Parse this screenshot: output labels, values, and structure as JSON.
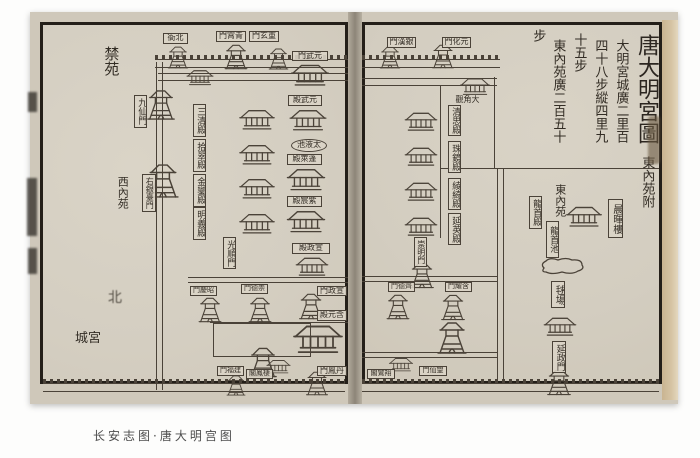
{
  "caption": "长安志图·唐大明宫图",
  "title": {
    "main": "唐大明宮圖",
    "sub": "東內苑附"
  },
  "measure_columns": [
    {
      "name": "measure-col-1",
      "text": "大明宮城廣二里百",
      "x": 612,
      "y": 26,
      "h": 130
    },
    {
      "name": "measure-col-2",
      "text": "四十八步縱四里九",
      "x": 591,
      "y": 26,
      "h": 130
    },
    {
      "name": "measure-col-3",
      "text": "十五步",
      "x": 570,
      "y": 26,
      "h": 52
    },
    {
      "name": "measure-col-4",
      "text": "東內苑廣二百五十",
      "x": 549,
      "y": 26,
      "h": 130
    },
    {
      "name": "measure-col-5",
      "text": "步",
      "x": 529,
      "y": 26,
      "h": 18
    }
  ],
  "north_mark": "北",
  "labels": [
    {
      "name": "label-beiya",
      "text": "衙北",
      "type": "box-h",
      "x": 163,
      "y": 33,
      "w": 25,
      "h": 11,
      "fs": 8
    },
    {
      "name": "label-qingxiao-gate",
      "text": "門霄青",
      "type": "box-h",
      "x": 216,
      "y": 31,
      "w": 30,
      "h": 11,
      "fs": 8
    },
    {
      "name": "label-chongxuan-gate",
      "text": "門玄重",
      "type": "box-h",
      "x": 249,
      "y": 31,
      "w": 30,
      "h": 11,
      "fs": 8
    },
    {
      "name": "label-yuanwu-gate",
      "text": "門武元",
      "type": "box-h",
      "x": 292,
      "y": 51,
      "w": 36,
      "h": 10,
      "fs": 8
    },
    {
      "name": "label-yuanwu-hall",
      "text": "殿武元",
      "type": "box-h",
      "x": 288,
      "y": 95,
      "w": 34,
      "h": 11,
      "fs": 8
    },
    {
      "name": "label-taiye-pool",
      "text": "池液太",
      "type": "oval",
      "x": 291,
      "y": 139,
      "w": 36,
      "h": 13,
      "fs": 8
    },
    {
      "name": "label-penglai-hall",
      "text": "殿萊蓬",
      "type": "box-h",
      "x": 287,
      "y": 154,
      "w": 35,
      "h": 11,
      "fs": 8
    },
    {
      "name": "label-zichen-hall",
      "text": "殿宸紫",
      "type": "box-h",
      "x": 287,
      "y": 196,
      "w": 35,
      "h": 11,
      "fs": 8
    },
    {
      "name": "label-xuanzheng-hall",
      "text": "殿政宣",
      "type": "box-h",
      "x": 292,
      "y": 243,
      "w": 38,
      "h": 11,
      "fs": 8
    },
    {
      "name": "label-xuanzheng-gate",
      "text": "門政宣",
      "type": "box-h",
      "x": 317,
      "y": 286,
      "w": 30,
      "h": 10,
      "fs": 8
    },
    {
      "name": "label-hanyuan-hall",
      "text": "殿元含",
      "type": "box-h",
      "x": 317,
      "y": 310,
      "w": 30,
      "h": 11,
      "fs": 8
    },
    {
      "name": "label-danfeng-gate",
      "text": "門鳳丹",
      "type": "box-h",
      "x": 317,
      "y": 366,
      "w": 30,
      "h": 10,
      "fs": 8
    },
    {
      "name": "label-jianfu-gate",
      "text": "門福建",
      "type": "box-h",
      "x": 217,
      "y": 366,
      "w": 27,
      "h": 10,
      "fs": 7
    },
    {
      "name": "label-qifeng-pavilion",
      "text": "閣鳳棲",
      "type": "box-h",
      "x": 246,
      "y": 369,
      "w": 27,
      "h": 10,
      "fs": 7
    },
    {
      "name": "label-zhaoqing-gate",
      "text": "門慶昭",
      "type": "box-h",
      "x": 190,
      "y": 286,
      "w": 27,
      "h": 10,
      "fs": 7
    },
    {
      "name": "label-chongde-gate",
      "text": "門德崇",
      "type": "box-h",
      "x": 241,
      "y": 284,
      "w": 27,
      "h": 10,
      "fs": 7
    },
    {
      "name": "label-guangshun-gate",
      "text": "光順門",
      "type": "box-v",
      "x": 223,
      "y": 237,
      "w": 13,
      "h": 32,
      "fs": 9
    },
    {
      "name": "label-jiuxian-gate",
      "text": "九仙門",
      "type": "box-v",
      "x": 134,
      "y": 95,
      "w": 13,
      "h": 33,
      "fs": 9
    },
    {
      "name": "label-youyintai-gate",
      "text": "右銀臺門",
      "type": "box-v",
      "x": 142,
      "y": 174,
      "w": 14,
      "h": 38,
      "fs": 8
    },
    {
      "name": "label-sanqing-hall",
      "text": "三清殿",
      "type": "box-v",
      "x": 193,
      "y": 104,
      "w": 13,
      "h": 33,
      "fs": 9
    },
    {
      "name": "label-shicui-hall",
      "text": "拾翠殿",
      "type": "box-v",
      "x": 193,
      "y": 139,
      "w": 13,
      "h": 33,
      "fs": 9
    },
    {
      "name": "label-jinluan-hall",
      "text": "金鑾殿",
      "type": "box-v",
      "x": 193,
      "y": 174,
      "w": 13,
      "h": 33,
      "fs": 9
    },
    {
      "name": "label-mingyi-hall",
      "text": "明義殿",
      "type": "box-v",
      "x": 193,
      "y": 207,
      "w": 13,
      "h": 33,
      "fs": 9
    },
    {
      "name": "label-jinyuan",
      "text": "禁苑",
      "type": "txt-v",
      "x": 101,
      "y": 41,
      "w": 19,
      "h": 40,
      "fs": 15
    },
    {
      "name": "label-xineiyuan",
      "text": "西內苑",
      "type": "txt-v",
      "x": 116,
      "y": 170,
      "w": 13,
      "h": 44,
      "fs": 11
    },
    {
      "name": "label-gongcheng",
      "text": "城宮",
      "type": "txt-h",
      "x": 71,
      "y": 331,
      "w": 34,
      "h": 16,
      "fs": 13
    },
    {
      "name": "label-yinhan-gate",
      "text": "門漢銀",
      "type": "box-h",
      "x": 387,
      "y": 37,
      "w": 29,
      "h": 11,
      "fs": 8
    },
    {
      "name": "label-yuanhua-gate",
      "text": "門化元",
      "type": "box-h",
      "x": 442,
      "y": 37,
      "w": 29,
      "h": 11,
      "fs": 8
    },
    {
      "name": "label-dajiao-temple",
      "text": "觀角大",
      "type": "txt-h",
      "x": 453,
      "y": 95,
      "w": 29,
      "h": 10,
      "fs": 8
    },
    {
      "name": "label-qingsi-hall",
      "text": "清思殿",
      "type": "box-v",
      "x": 448,
      "y": 105,
      "w": 13,
      "h": 31,
      "fs": 9
    },
    {
      "name": "label-zhujing-hall",
      "text": "珠鏡殿",
      "type": "box-v",
      "x": 448,
      "y": 141,
      "w": 13,
      "h": 32,
      "fs": 9
    },
    {
      "name": "label-lingqi-hall",
      "text": "綾綺殿",
      "type": "box-v",
      "x": 448,
      "y": 178,
      "w": 13,
      "h": 32,
      "fs": 9
    },
    {
      "name": "label-yanying-hall",
      "text": "延英殿",
      "type": "box-v",
      "x": 448,
      "y": 213,
      "w": 13,
      "h": 32,
      "fs": 9
    },
    {
      "name": "label-chongming-gate",
      "text": "崇明門",
      "type": "box-v",
      "x": 414,
      "y": 237,
      "w": 13,
      "h": 30,
      "fs": 8
    },
    {
      "name": "label-qide-gate",
      "text": "門德齊",
      "type": "box-h",
      "x": 388,
      "y": 282,
      "w": 27,
      "h": 10,
      "fs": 7
    },
    {
      "name": "label-hanyao-gate",
      "text": "門耀含",
      "type": "box-h",
      "x": 445,
      "y": 282,
      "w": 27,
      "h": 10,
      "fs": 7
    },
    {
      "name": "label-wangxian-gate",
      "text": "門仙望",
      "type": "box-h",
      "x": 419,
      "y": 366,
      "w": 28,
      "h": 10,
      "fs": 7
    },
    {
      "name": "label-xiangluan-pavilion",
      "text": "閣鸞翔",
      "type": "box-h",
      "x": 367,
      "y": 369,
      "w": 28,
      "h": 10,
      "fs": 7
    },
    {
      "name": "label-dongneiyuan",
      "text": "東內苑",
      "type": "txt-v",
      "x": 553,
      "y": 181,
      "w": 14,
      "h": 38,
      "fs": 11
    },
    {
      "name": "label-longshou-hall",
      "text": "龍首殿",
      "type": "box-v",
      "x": 529,
      "y": 196,
      "w": 13,
      "h": 33,
      "fs": 9
    },
    {
      "name": "label-chenhui-tower",
      "text": "晨暉樓",
      "type": "box-v",
      "x": 608,
      "y": 199,
      "w": 15,
      "h": 39,
      "fs": 10
    },
    {
      "name": "label-longshou-pool",
      "text": "龍首池",
      "type": "box-v",
      "x": 546,
      "y": 221,
      "w": 13,
      "h": 37,
      "fs": 9
    },
    {
      "name": "label-qiuchang",
      "text": "毬場",
      "type": "box-v",
      "x": 551,
      "y": 281,
      "w": 14,
      "h": 27,
      "fs": 10
    },
    {
      "name": "label-yanzheng-gate",
      "text": "延政門",
      "type": "box-v",
      "x": 552,
      "y": 341,
      "w": 14,
      "h": 32,
      "fs": 9
    }
  ],
  "walls": [
    {
      "name": "north-wall-left",
      "kind": "cren",
      "x": 155,
      "y": 55,
      "w": 193,
      "h": 13
    },
    {
      "name": "inner-north-wall-left",
      "kind": "double",
      "x": 158,
      "y": 73,
      "w": 190,
      "h": 8
    },
    {
      "name": "west-wall",
      "kind": "vert",
      "x": 156,
      "y": 62,
      "w": 7,
      "h": 328
    },
    {
      "name": "mid-wall-left",
      "kind": "double",
      "x": 188,
      "y": 277,
      "w": 160,
      "h": 6
    },
    {
      "name": "court-wall-left",
      "kind": "line-h",
      "x": 210,
      "y": 322,
      "w": 138,
      "h": 2
    },
    {
      "name": "south-wall-left",
      "kind": "cren",
      "x": 43,
      "y": 379,
      "w": 302,
      "h": 13
    },
    {
      "name": "north-wall-right",
      "kind": "cren",
      "x": 362,
      "y": 55,
      "w": 138,
      "h": 13
    },
    {
      "name": "inner-north-wall-right",
      "kind": "double",
      "x": 362,
      "y": 78,
      "w": 135,
      "h": 8
    },
    {
      "name": "east-column-wall",
      "kind": "line-v",
      "x": 440,
      "y": 86,
      "w": 2,
      "h": 152
    },
    {
      "name": "text-block-left-line",
      "kind": "line-v",
      "x": 494,
      "y": 77,
      "w": 2,
      "h": 92
    },
    {
      "name": "text-block-bottom-line",
      "kind": "line-h",
      "x": 440,
      "y": 168,
      "w": 219,
      "h": 2
    },
    {
      "name": "palace-east-wall",
      "kind": "vert",
      "x": 497,
      "y": 169,
      "w": 7,
      "h": 212
    },
    {
      "name": "mid-wall-right",
      "kind": "double",
      "x": 362,
      "y": 276,
      "w": 135,
      "h": 6
    },
    {
      "name": "lower-wall-right",
      "kind": "double",
      "x": 362,
      "y": 352,
      "w": 135,
      "h": 6
    },
    {
      "name": "south-wall-right",
      "kind": "cren",
      "x": 362,
      "y": 379,
      "w": 297,
      "h": 13
    }
  ],
  "courtyards": [
    {
      "name": "hanyuan-forecourt",
      "x": 213,
      "y": 323,
      "w": 96,
      "h": 32
    }
  ],
  "buildings": [
    {
      "name": "north-gate-tower-1",
      "kind": "tower",
      "x": 165,
      "y": 45,
      "w": 26,
      "h": 25
    },
    {
      "name": "north-gate-tower-2",
      "kind": "tower",
      "x": 222,
      "y": 43,
      "w": 28,
      "h": 28
    },
    {
      "name": "north-gate-tower-3",
      "kind": "tower",
      "x": 266,
      "y": 47,
      "w": 25,
      "h": 24
    },
    {
      "name": "inner-north-hall",
      "kind": "hall",
      "x": 186,
      "y": 68,
      "w": 28,
      "h": 19
    },
    {
      "name": "xuanwu-gate-hall",
      "kind": "hall",
      "x": 291,
      "y": 61,
      "w": 38,
      "h": 28
    },
    {
      "name": "yuanwu-hall-bldg",
      "kind": "hall",
      "x": 288,
      "y": 107,
      "w": 40,
      "h": 26
    },
    {
      "name": "penglai-hall-bldg",
      "kind": "hall",
      "x": 283,
      "y": 166,
      "w": 46,
      "h": 27
    },
    {
      "name": "zichen-hall-bldg",
      "kind": "hall",
      "x": 283,
      "y": 208,
      "w": 46,
      "h": 27
    },
    {
      "name": "xuanzheng-hall-bldg",
      "kind": "hall",
      "x": 290,
      "y": 255,
      "w": 44,
      "h": 23
    },
    {
      "name": "west-hall-1",
      "kind": "hall",
      "x": 237,
      "y": 107,
      "w": 40,
      "h": 25
    },
    {
      "name": "west-hall-2",
      "kind": "hall",
      "x": 237,
      "y": 142,
      "w": 40,
      "h": 25
    },
    {
      "name": "west-hall-3",
      "kind": "hall",
      "x": 237,
      "y": 176,
      "w": 40,
      "h": 25
    },
    {
      "name": "west-hall-4",
      "kind": "hall",
      "x": 237,
      "y": 211,
      "w": 40,
      "h": 25
    },
    {
      "name": "jiuxian-gate-tower",
      "kind": "tower",
      "x": 146,
      "y": 86,
      "w": 30,
      "h": 38
    },
    {
      "name": "youyintai-tower",
      "kind": "tower",
      "x": 146,
      "y": 160,
      "w": 34,
      "h": 42
    },
    {
      "name": "zhaoqing-tower",
      "kind": "tower",
      "x": 196,
      "y": 296,
      "w": 28,
      "h": 28
    },
    {
      "name": "chongde-tower",
      "kind": "tower",
      "x": 246,
      "y": 296,
      "w": 28,
      "h": 28
    },
    {
      "name": "xuanzheng-gate-tower",
      "kind": "tower",
      "x": 298,
      "y": 291,
      "w": 26,
      "h": 31
    },
    {
      "name": "hanyuan-hall-bldg",
      "kind": "hall",
      "x": 293,
      "y": 321,
      "w": 50,
      "h": 36
    },
    {
      "name": "longwei-tower",
      "kind": "tower",
      "x": 248,
      "y": 345,
      "w": 30,
      "h": 35
    },
    {
      "name": "jianfu-tower",
      "kind": "tower",
      "x": 222,
      "y": 374,
      "w": 28,
      "h": 23
    },
    {
      "name": "danfeng-tower",
      "kind": "tower",
      "x": 300,
      "y": 370,
      "w": 34,
      "h": 27
    },
    {
      "name": "south-hall-small",
      "kind": "hall",
      "x": 266,
      "y": 358,
      "w": 25,
      "h": 17
    },
    {
      "name": "yinhan-tower",
      "kind": "tower",
      "x": 375,
      "y": 45,
      "w": 30,
      "h": 25
    },
    {
      "name": "yuanhua-tower",
      "kind": "tower",
      "x": 428,
      "y": 43,
      "w": 30,
      "h": 27
    },
    {
      "name": "right-inner-hall",
      "kind": "hall",
      "x": 458,
      "y": 76,
      "w": 34,
      "h": 21
    },
    {
      "name": "east-hall-1",
      "kind": "hall",
      "x": 403,
      "y": 110,
      "w": 36,
      "h": 23
    },
    {
      "name": "east-hall-2",
      "kind": "hall",
      "x": 403,
      "y": 145,
      "w": 36,
      "h": 23
    },
    {
      "name": "east-hall-3",
      "kind": "hall",
      "x": 403,
      "y": 180,
      "w": 36,
      "h": 23
    },
    {
      "name": "east-hall-4",
      "kind": "hall",
      "x": 403,
      "y": 215,
      "w": 36,
      "h": 23
    },
    {
      "name": "chongming-tower",
      "kind": "tower",
      "x": 407,
      "y": 261,
      "w": 30,
      "h": 29
    },
    {
      "name": "qide-tower",
      "kind": "tower",
      "x": 384,
      "y": 293,
      "w": 28,
      "h": 28
    },
    {
      "name": "hanyao-tower",
      "kind": "tower",
      "x": 438,
      "y": 293,
      "w": 30,
      "h": 29
    },
    {
      "name": "wangxian-tower",
      "kind": "tower",
      "x": 436,
      "y": 316,
      "w": 32,
      "h": 44
    },
    {
      "name": "south-hall-right",
      "kind": "hall",
      "x": 388,
      "y": 356,
      "w": 26,
      "h": 17
    },
    {
      "name": "garden-hall",
      "kind": "hall",
      "x": 566,
      "y": 203,
      "w": 36,
      "h": 27
    },
    {
      "name": "longshou-pond",
      "kind": "pond",
      "x": 537,
      "y": 256,
      "w": 50,
      "h": 20
    },
    {
      "name": "qiuchang-hall",
      "kind": "hall",
      "x": 542,
      "y": 315,
      "w": 36,
      "h": 23
    },
    {
      "name": "yanzheng-tower",
      "kind": "tower",
      "x": 542,
      "y": 368,
      "w": 34,
      "h": 29
    }
  ],
  "spine_fragments": [
    {
      "x": 28,
      "y": 92,
      "w": 9,
      "h": 20
    },
    {
      "x": 27,
      "y": 178,
      "w": 10,
      "h": 58
    },
    {
      "x": 28,
      "y": 248,
      "w": 9,
      "h": 26
    }
  ],
  "edge_stain": {
    "x": 648,
    "y": 116,
    "w": 12,
    "h": 48
  }
}
